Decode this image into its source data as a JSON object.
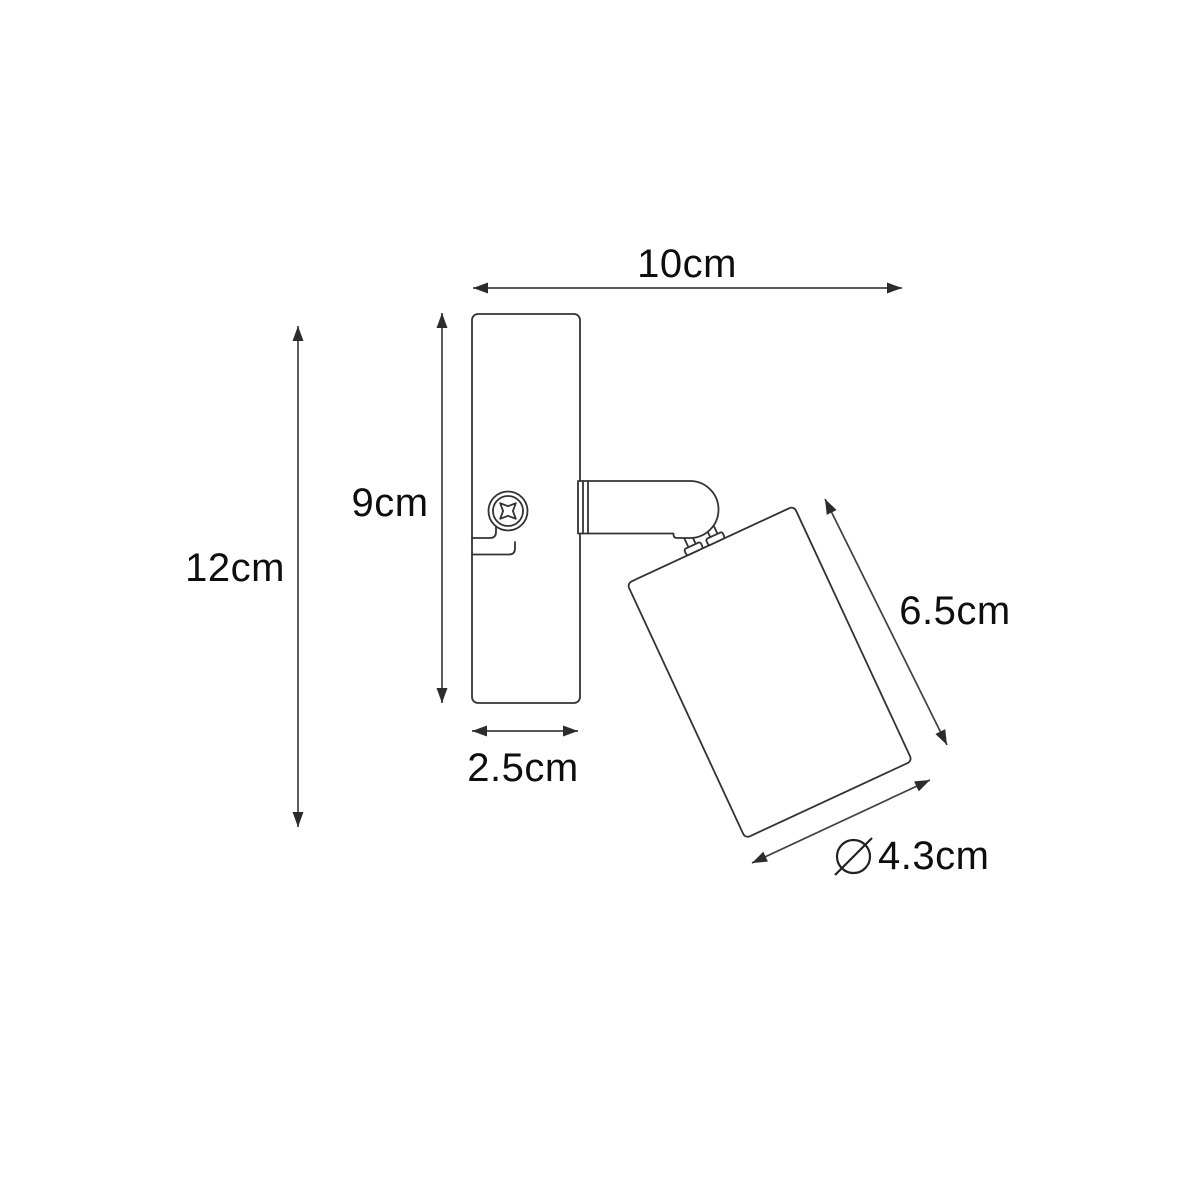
{
  "diagram": {
    "kind": "product-dimension-line-drawing",
    "colors": {
      "background": "#ffffff",
      "outline": "#333333",
      "dimension_line": "#404040",
      "label_text": "#0e0e0e"
    },
    "labels": {
      "width_total": "10cm",
      "height_total": "12cm",
      "plate_height": "9cm",
      "plate_width": "2.5cm",
      "shade_length": "6.5cm",
      "shade_diameter": "4.3cm",
      "diameter_symbol": "⌀"
    }
  }
}
